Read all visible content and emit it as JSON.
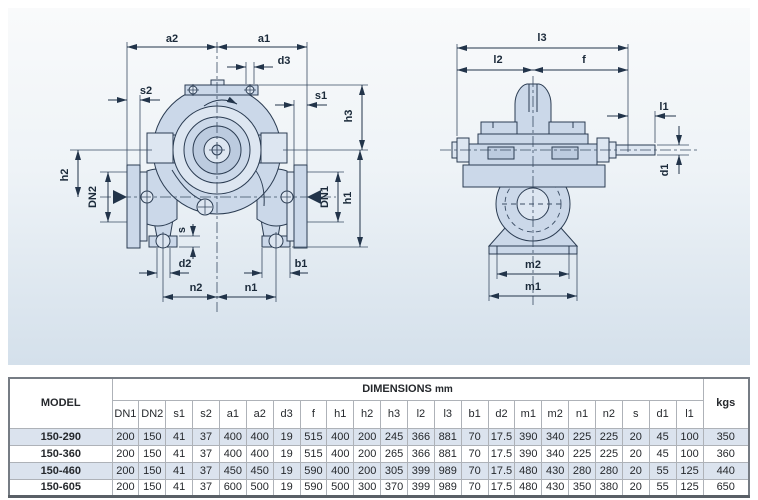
{
  "diagram": {
    "front": {
      "a2": "a2",
      "a1": "a1",
      "d3": "d3",
      "s2": "s2",
      "s1": "s1",
      "h3": "h3",
      "h1": "h1",
      "h2": "h2",
      "dn2": "DN2",
      "dn1": "DN1",
      "s": "s",
      "d2": "d2",
      "b1": "b1",
      "n2": "n2",
      "n1": "n1"
    },
    "side": {
      "l3": "l3",
      "l2": "l2",
      "f": "f",
      "l1": "l1",
      "d1": "d1",
      "m2": "m2",
      "m1": "m1"
    }
  },
  "table": {
    "model_header": "MODEL",
    "dimensions_header": "DIMENSIONS",
    "dimensions_unit": "mm",
    "weight_header": "kgs",
    "columns": [
      "DN1",
      "DN2",
      "s1",
      "s2",
      "a1",
      "a2",
      "d3",
      "f",
      "h1",
      "h2",
      "h3",
      "l2",
      "l3",
      "b1",
      "d2",
      "m1",
      "m2",
      "n1",
      "n2",
      "s",
      "d1",
      "l1"
    ],
    "rows": [
      {
        "model": "150-290",
        "values": [
          "200",
          "150",
          "41",
          "37",
          "400",
          "400",
          "19",
          "515",
          "400",
          "200",
          "245",
          "366",
          "881",
          "70",
          "17.5",
          "390",
          "340",
          "225",
          "225",
          "20",
          "45",
          "100"
        ],
        "kgs": "350"
      },
      {
        "model": "150-360",
        "values": [
          "200",
          "150",
          "41",
          "37",
          "400",
          "400",
          "19",
          "515",
          "400",
          "200",
          "265",
          "366",
          "881",
          "70",
          "17.5",
          "390",
          "340",
          "225",
          "225",
          "20",
          "45",
          "100"
        ],
        "kgs": "360"
      },
      {
        "model": "150-460",
        "values": [
          "200",
          "150",
          "41",
          "37",
          "450",
          "450",
          "19",
          "590",
          "400",
          "200",
          "305",
          "399",
          "989",
          "70",
          "17.5",
          "480",
          "430",
          "280",
          "280",
          "20",
          "55",
          "125"
        ],
        "kgs": "440"
      },
      {
        "model": "150-605",
        "values": [
          "200",
          "150",
          "41",
          "37",
          "600",
          "500",
          "19",
          "590",
          "500",
          "300",
          "370",
          "399",
          "989",
          "70",
          "17.5",
          "480",
          "430",
          "350",
          "380",
          "20",
          "55",
          "125"
        ],
        "kgs": "650"
      }
    ]
  },
  "colors": {
    "panel_top": "#f9fafb",
    "panel_bottom": "#d4e0eb",
    "line": "#2b3c52",
    "pump_fill": "#cbd8e9",
    "row_alt": "#dbe3ee",
    "text": "#25282c"
  }
}
